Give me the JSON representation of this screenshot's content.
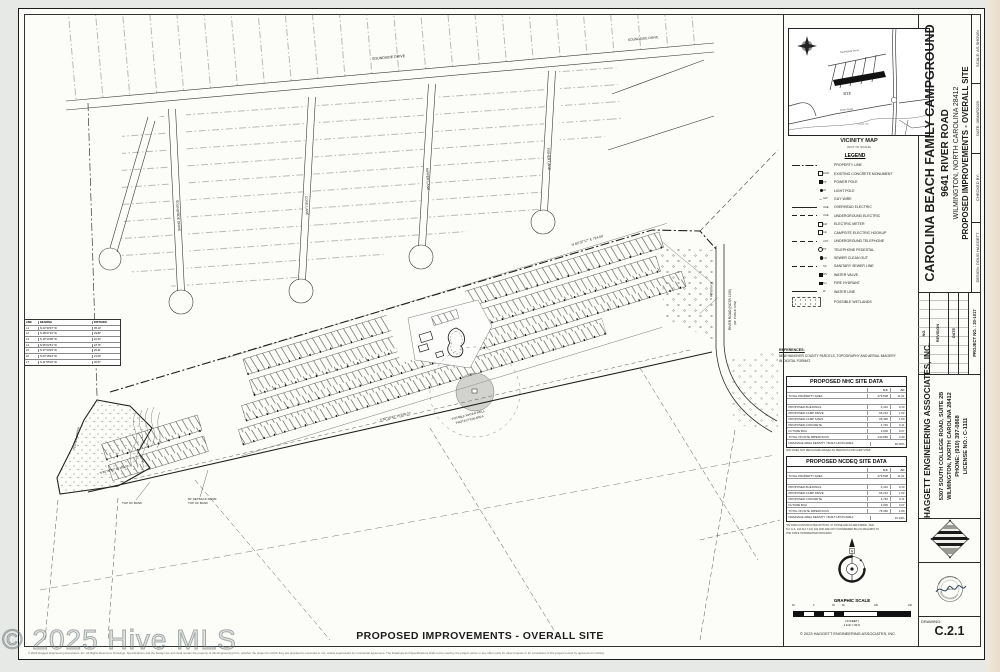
{
  "page": {
    "watermark": "© 2025 Hive MLS",
    "bottom_title": "PROPOSED IMPROVEMENTS - OVERALL SITE",
    "disclaimer": "© 2023 Haggett Engineering Associates, Inc.   All Rights Reserved.  Drawings, Specifications and the Design are and shall remain the property of this Engineering Firm, whether the project for which they are prepared is executed or not, unless superseded by contractual agreement.  The Drawings and Specifications shall not be used by the project owner or any other party for other projects or for completion of this project except by agreement in writing.",
    "scale_copyright": "© 2023 HAGGETT ENGINEERING ASSOCIATES, INC."
  },
  "vicinity": {
    "title": "VICINITY MAP",
    "subtitle": "(NOT TO SCALE)",
    "site_label": "SITE",
    "road_soundside": "Soundside Drive",
    "road_river": "River Road",
    "creek": "Telfair Cut"
  },
  "legend": {
    "title": "LEGEND",
    "items": [
      {
        "label": "PROPERTY LINE",
        "tag": ""
      },
      {
        "label": "EXISTING CONCRETE MONUMENT",
        "tag": "ECM"
      },
      {
        "label": "POWER POLE",
        "tag": "PP"
      },
      {
        "label": "LIGHT POLE",
        "tag": "LP"
      },
      {
        "label": "GUY WIRE",
        "tag": "GW"
      },
      {
        "label": "OVERHEAD ELECTRIC",
        "tag": "OHE"
      },
      {
        "label": "UNDERGROUND ELECTRIC",
        "tag": "UGE"
      },
      {
        "label": "ELECTRIC METER",
        "tag": "EM"
      },
      {
        "label": "CAMPSITE ELECTRIC HOOKUP",
        "tag": "CE"
      },
      {
        "label": "UNDERGROUND TELEPHONE",
        "tag": "UGT"
      },
      {
        "label": "TELEPHONE PEDESTAL",
        "tag": "TP"
      },
      {
        "label": "SEWER CLEAN OUT",
        "tag": "CO"
      },
      {
        "label": "SANITARY SEWER LINE",
        "tag": "SS"
      },
      {
        "label": "WATER VALVE",
        "tag": "WV"
      },
      {
        "label": "FIRE HYDRANT",
        "tag": "FH"
      },
      {
        "label": "WATER LINE",
        "tag": "W"
      },
      {
        "label": "POSSIBLE WETLANDS",
        "tag": ""
      }
    ]
  },
  "references": {
    "title": "REFERENCES:",
    "line1": "NEW HANOVER COUNTY PARCELS, TOPOGRAPHY AND AERIAL IMAGERY",
    "line2": "IN DIGITAL FORMAT."
  },
  "nhc": {
    "title": "PROPOSED NHC SITE DATA",
    "col_sf": "S.F.",
    "col_ac": "AC",
    "rows": [
      {
        "l": "TOTAL PROPERTY AREA",
        "sf": "479,508",
        "ac": "11.01"
      },
      {
        "l": "",
        "sf": "",
        "ac": ""
      },
      {
        "l": "PROPOSED BUILDINGS",
        "sf": "4,410",
        "ac": "0.10"
      },
      {
        "l": "PROPOSED CAMP DRIVE",
        "sf": "66,210",
        "ac": "1.52"
      },
      {
        "l": "PROPOSED CAMP SITES",
        "sf": "65,490",
        "ac": "1.50"
      },
      {
        "l": "PROPOSED CONCRETE",
        "sf": "4,740",
        "ac": "0.11"
      },
      {
        "l": "FUTURE BUA",
        "sf": "3,000",
        "ac": "0.07"
      },
      {
        "l": "TOTAL ON-SITE IMPERVIOUS",
        "sf": "143,850",
        "ac": "3.30"
      }
    ],
    "density_label": "DRAINAGE AREA DENSITY / BUILT-UPON AREA",
    "density_value": "30.00%",
    "note": "NHC DOES NOT RECOGNIZE GRAVEL AS PERVIOUS FOR CAMP SITES"
  },
  "ncdeq": {
    "title": "PROPOSED NCDEQ SITE DATA",
    "col_sf": "S.F.",
    "col_ac": "AC",
    "rows": [
      {
        "l": "TOTAL PROPERTY AREA",
        "sf": "479,508",
        "ac": "11.01"
      },
      {
        "l": "",
        "sf": "",
        "ac": ""
      },
      {
        "l": "PROPOSED BUILDINGS",
        "sf": "4,410",
        "ac": "0.10"
      },
      {
        "l": "PROPOSED CAMP DRIVE",
        "sf": "66,210",
        "ac": "1.52"
      },
      {
        "l": "PROPOSED CONCRETE",
        "sf": "4,740",
        "ac": "0.11"
      },
      {
        "l": "FUTURE BUA",
        "sf": "3,000",
        "ac": "0.07"
      },
      {
        "l": "TOTAL ON-SITE IMPERVIOUS",
        "sf": "78,360",
        "ac": "1.80"
      }
    ],
    "density_label": "DRAINAGE AREA DENSITY / BUILT-UPON AREA",
    "density_value": "16.34%",
    "footnote1": "*RV PADS CONSTRUCTED WITH NO. 57 STONE AND FILTER FABRIC, PER",
    "footnote2": "N.C.G.S. 143-214.7 (b2) (b4) AND ARE NOT CONSIDERED BUA IN REGARDS TO",
    "footnote3": "THE STATE STORMWATER PROGRAM"
  },
  "titleblock": {
    "project": "CAROLINA BEACH FAMILY CAMPGROUND",
    "address": "9641 RIVER ROAD",
    "city": "WILMINGTON, NORTH CAROLINA 28412",
    "sheet": "PROPOSED  IMPROVEMENTS - OVERALL SITE",
    "scale": "SCALE:  AS SHOWN",
    "date": "DATE:  06MAR2023",
    "checked": "CHECKED BY:",
    "design": "DESIGN: DOUG HAGGETT",
    "rev_no": "NO.",
    "rev_label": "REVISION",
    "rev_date": "DATE",
    "project_no": "PROJECT NO. :  20-1017",
    "firm": "HAGGETT ENGINEERING ASSOCIATES, INC.",
    "firm_addr1": "5307 SOUTH COLLEGE ROAD, SUITE 2B",
    "firm_addr2": "WILMINGTON, NORTH CAROLINA 28412",
    "firm_phone": "PHONE:  (910) 397-0868",
    "firm_license": "LICENSE NO.: C-1111",
    "seal_top": "NORTH CAROLINA",
    "seal_center": "SEAL",
    "seal_bottom": "DOUGLAS N. HAGGETT",
    "drawing_label": "DRAWING:",
    "drawing_no": "C.2.1"
  },
  "scalebar": {
    "title": "GRAPHIC SCALE",
    "units": "( IN FEET )",
    "ratio": "1 inch = 60 ft.",
    "ticks": [
      "60",
      "0",
      "30",
      "60",
      "120",
      "240"
    ]
  },
  "compass": {
    "north": "N"
  },
  "plan": {
    "soundside_top": "SOUNDSIDE DRIVE",
    "soundside": "SOUNDSIDE DRIVE",
    "cove": "COVE LANE",
    "nipper": "NIPPER LANE",
    "fisher": "FISHER LANE",
    "river_road_1": "RIVER ROAD (NCSR 1100)",
    "river_road_2": "(60' PUBLIC R/W)",
    "well_1": "POTABLE WATER WELL",
    "well_2": "PROTECTION AREA",
    "top_of_bank": "TOP OF BANK",
    "setback_1": "50' SETBACK FROM",
    "setback_2": "TOP OF BANK",
    "bearing_1": "N 89°37'17\" E   724.00'",
    "bearing_2": "S 86°16'44\" W   636.07'",
    "bearing_3": "S 03°58'04\" E",
    "bearing_4": "N 85°36'45\" W   183.32'",
    "creek": "TELFAIR CREEK"
  },
  "line_table": {
    "h1": "LINE",
    "h2": "BEARING",
    "h3": "DISTANCE",
    "rows": [
      {
        "n": "L1",
        "b": "N 24°30'37\" W",
        "d": "35.10'"
      },
      {
        "n": "L2",
        "b": "N 48°27'32\" W",
        "d": "29.89'"
      },
      {
        "n": "L3",
        "b": "N 19°14'08\" W",
        "d": "22.43'"
      },
      {
        "n": "L4",
        "b": "N 56°02'51\" W",
        "d": "18.76'"
      },
      {
        "n": "L5",
        "b": "N 37°40'15\" W",
        "d": "26.31'"
      },
      {
        "n": "L6",
        "b": "N 63°18'44\" W",
        "d": "21.09'"
      },
      {
        "n": "L7",
        "b": "N 41°55'23\" W",
        "d": "30.57'"
      }
    ]
  }
}
